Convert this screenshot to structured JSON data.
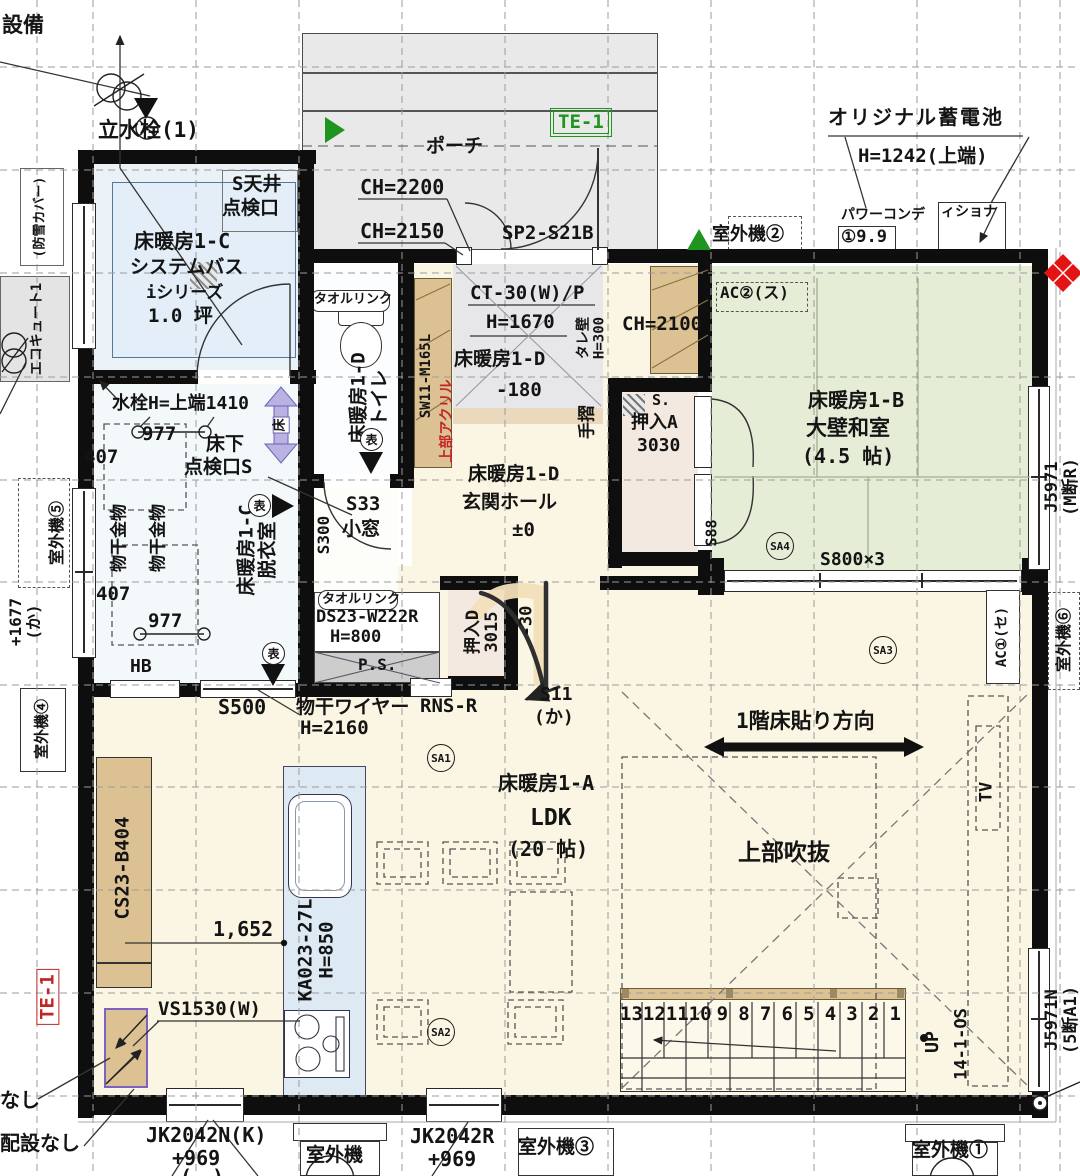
{
  "top": {
    "setsubi": "設備",
    "tap": "立水栓(1)",
    "porch": "ポーチ",
    "te1": "TE-1",
    "ch2200": "CH=2200",
    "ch2150": "CH=2150",
    "door": "SP2-S21B",
    "battery": "オリジナル蓄電池",
    "battery_h": "H=1242(上端)",
    "pc1": "パワーコンデ",
    "pc2": "ィショナ",
    "pc_val": "①9.9",
    "out2": "室外機②"
  },
  "left": {
    "snow": "(防雪カバー)",
    "eco": "エコキュート1",
    "out5": "室外機⑤",
    "h1677": "+1677",
    "h1677b": "(か)",
    "out4": "室外機④",
    "te1_red": "TE-1",
    "nashi": "なし",
    "haisetsu": "配設なし"
  },
  "right": {
    "j5971": "J5971",
    "j5971b": "(M断R)",
    "out6": "室外機⑥",
    "ac1": "AC①(セ)",
    "j5971n": "J5971N",
    "j5971nb": "(5断A1)"
  },
  "bottom": {
    "jk_n": "JK2042N(K)",
    "jk_n2": "+969",
    "jk_n3": "(　)",
    "out_c": "室外機",
    "jk_r": "JK2042R",
    "jk_r2": "+969",
    "out3": "室外機③",
    "out1": "室外機①"
  },
  "bath": {
    "ceil1": "S天井",
    "ceil2": "点検口",
    "heat": "床暖房1-C",
    "name": "システムバス",
    "series": "iシリーズ",
    "size": "1.0 坪"
  },
  "washroom": {
    "heat": "床暖房1-C",
    "name": "脱衣室",
    "faucet": "水栓H=上端1410",
    "d977a": "977",
    "d407a": "407",
    "uf1": "床下",
    "uf2": "点検口S",
    "hang": "物干金物",
    "d977b": "977",
    "d407b": "407",
    "hb": "HB",
    "s500": "S500",
    "wire1": "物干ワイヤー",
    "wire2": "H=2160"
  },
  "toilet": {
    "towel": "タオルリンク",
    "heat": "床暖房1-D",
    "name": "トイレ",
    "win": "SW11-M165L",
    "acryl": "上部アクリル",
    "s33": "S33",
    "komado": "小窓",
    "s300": "S300"
  },
  "entrance": {
    "ct": "CT-30(W)/P",
    "h1670": "H=1670",
    "heat": "床暖房1-D",
    "doma": "-180",
    "tare": "タレ壁",
    "tare_h": "H=300",
    "ch2100": "CH=2100",
    "tesuri": "手摺",
    "heat2": "床暖房1-D",
    "hall": "玄関ホール",
    "pm0": "±0",
    "s88": "S88",
    "s11": "S11",
    "s11b": "(か)",
    "m30": "-30",
    "rns": "RNS-R"
  },
  "closet": {
    "a": "押入A",
    "a_size": "3030",
    "s": "S.",
    "d": "押入D",
    "d_size": "3015"
  },
  "vanity": {
    "towel": "タオルリンク",
    "model": "DS23-W222R",
    "h": "H=800",
    "ps": "P.S."
  },
  "jr": {
    "heat": "床暖房1-B",
    "name": "大壁和室",
    "size": "(4.5 帖)",
    "sa4": "SA4",
    "s800": "S800×3",
    "ac2": "AC②(ス)"
  },
  "ldk": {
    "heat": "床暖房1-A",
    "name": "LDK",
    "size": "(20 帖)",
    "sa1": "SA1",
    "sa2": "SA2",
    "sa3": "SA3",
    "dir": "1階床貼り方向",
    "void": "上部吹抜",
    "tv": "TV",
    "dim": "1,652"
  },
  "kitchen": {
    "model": "KA023-27L",
    "h": "H=850",
    "cab": "CS23-B404",
    "vs": "VS1530(W)"
  },
  "stairs": {
    "up": "UP",
    "code": "14-1-OS",
    "numbers": [
      "13",
      "12",
      "11",
      "10",
      "9",
      "8",
      "7",
      "6",
      "5",
      "4",
      "3",
      "2",
      "1"
    ]
  },
  "marks": {
    "omote": "表",
    "floor": "床"
  }
}
